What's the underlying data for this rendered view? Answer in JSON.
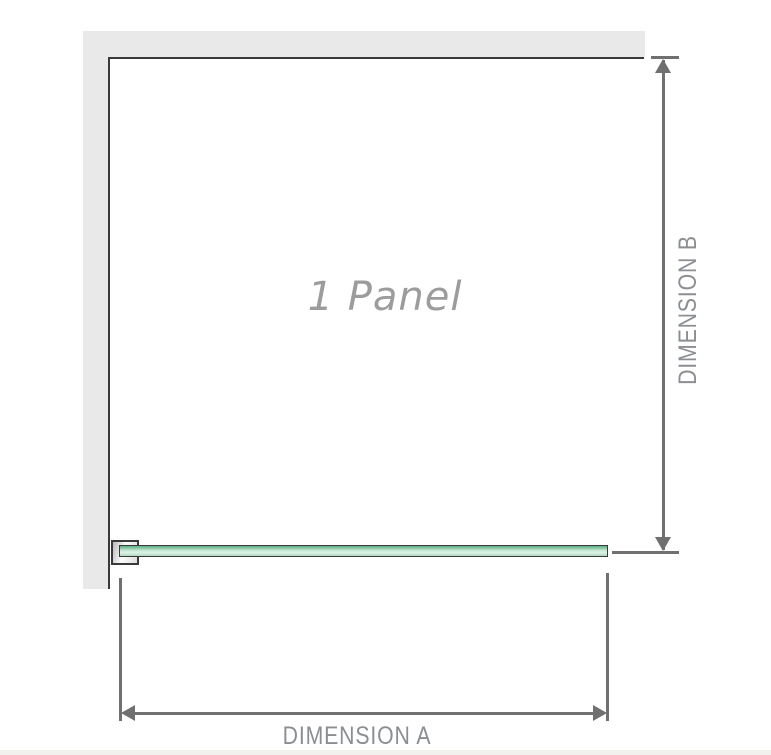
{
  "diagram": {
    "panel_label": "1 Panel",
    "dimension_a_label": "DIMENSION A",
    "dimension_b_label": "DIMENSION B"
  },
  "colors": {
    "wall_fill": "#e9e9e9",
    "wall_edge_dark": "#3a3a3a",
    "glass_green_top": "#5fae84",
    "glass_green_light": "#cdebdb",
    "glass_green_bottom": "#aad8c0",
    "dimension_line_gray": "#707070",
    "dimension_label_gray": "#8b8e92",
    "panel_label_gray": "#9c9c9c",
    "bottom_strip": "#f3f1ee"
  }
}
